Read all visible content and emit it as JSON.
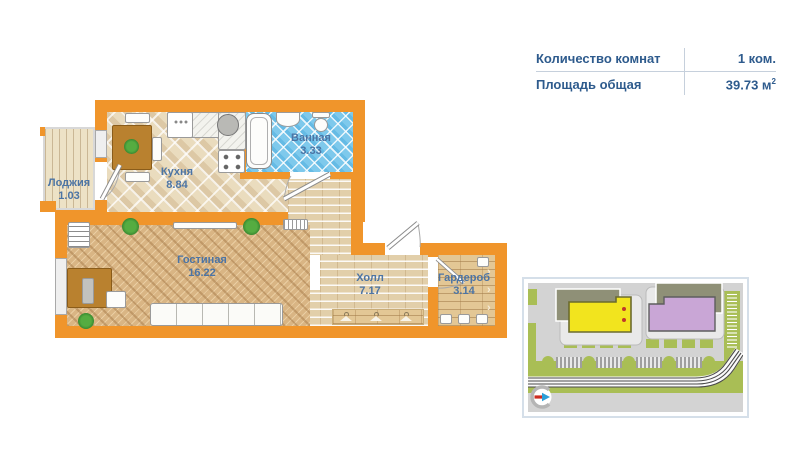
{
  "info_panel": {
    "rows": [
      {
        "label": "Количество комнат",
        "value": "1 ком.",
        "value_sup": ""
      },
      {
        "label": "Площадь общая",
        "value": "39.73 м",
        "value_sup": "2"
      }
    ]
  },
  "floor_plan": {
    "rooms": [
      {
        "name": "Лоджия",
        "area": "1.03"
      },
      {
        "name": "Кухня",
        "area": "8.84"
      },
      {
        "name": "Ванная",
        "area": "3.33"
      },
      {
        "name": "Гостиная",
        "area": "16.22"
      },
      {
        "name": "Холл",
        "area": "7.17"
      },
      {
        "name": "Гардероб",
        "area": "3.14"
      }
    ],
    "colors": {
      "wall": "#F0952B",
      "label": "#4C74A4",
      "bath_tile": "#7EC9EC"
    },
    "wardrobe_chevron": "›"
  },
  "site_map": {
    "colors": {
      "background": "#D3D3D3",
      "grass": "#A9BE55",
      "road_line": "#4A4A4A",
      "highlight_building": "#F2E41E",
      "highlight_outline": "#6B6B2F",
      "neighbor_building": "#C9A6D6",
      "neighbor_outline": "#5E5E5E",
      "back_building": "#8F9077",
      "entrance_dot": "#C0392B",
      "compass_red": "#CC2D22",
      "compass_blue": "#2D9FD8",
      "parking_tick": "#555555"
    }
  }
}
